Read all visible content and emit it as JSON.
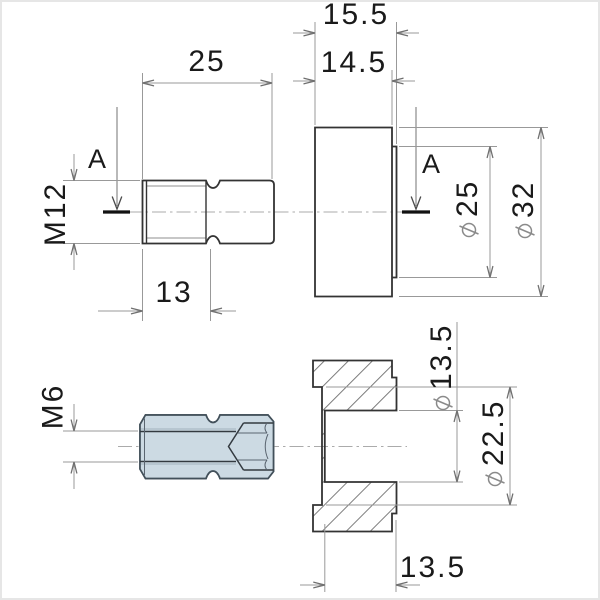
{
  "drawing": {
    "section_label": "A",
    "dimensions": {
      "bolt_length": "25",
      "bolt_thread_length": "13",
      "bolt_thread": "M12",
      "body_total_length": "15.5",
      "body_length": "14.5",
      "boss_diameter": "25",
      "body_outer_diameter": "32",
      "adapter_thread": "M6",
      "bore_diameter": "13.5",
      "counterbore_diameter": "22.5",
      "counterbore_depth": "13.5"
    },
    "colors": {
      "part_fill": "#ccdae3",
      "outline": "#333333",
      "dim_line": "#999999",
      "centerline": "#ababab",
      "hatch": "#7d7d7d",
      "text": "#1a1a1a"
    }
  }
}
